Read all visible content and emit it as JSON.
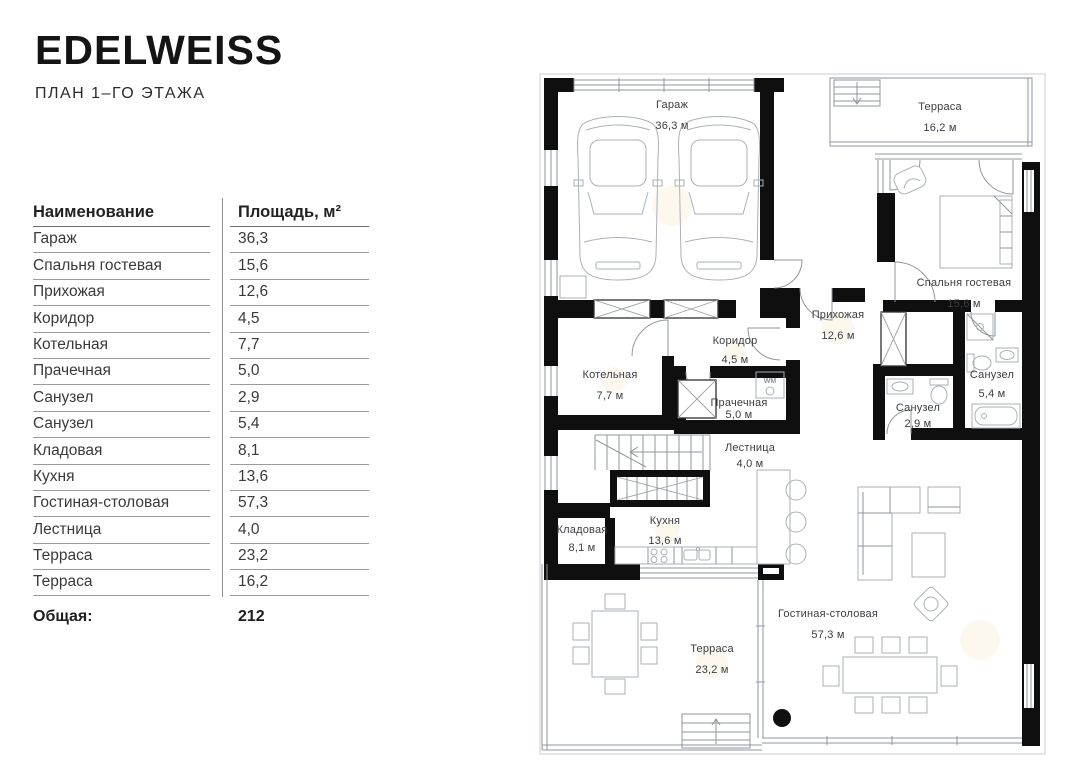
{
  "brand": {
    "logo": "EDELWEISS",
    "subtitle": "ПЛАН 1–ГО ЭТАЖА"
  },
  "table": {
    "header": {
      "name": "Наименование",
      "area": "Площадь, м²"
    },
    "rows": [
      {
        "name": "Гараж",
        "area": "36,3"
      },
      {
        "name": "Спальня гостевая",
        "area": "15,6"
      },
      {
        "name": "Прихожая",
        "area": "12,6"
      },
      {
        "name": "Коридор",
        "area": "4,5"
      },
      {
        "name": "Котельная",
        "area": "7,7"
      },
      {
        "name": "Прачечная",
        "area": "5,0"
      },
      {
        "name": "Санузел",
        "area": "2,9"
      },
      {
        "name": "Санузел",
        "area": "5,4"
      },
      {
        "name": "Кладовая",
        "area": "8,1"
      },
      {
        "name": "Кухня",
        "area": "13,6"
      },
      {
        "name": "Гостиная-столовая",
        "area": "57,3"
      },
      {
        "name": "Лестница",
        "area": "4,0"
      },
      {
        "name": "Терраса",
        "area": "23,2"
      },
      {
        "name": "Терраса",
        "area": "16,2"
      }
    ],
    "total_label": "Общая:",
    "total_value": "212"
  },
  "plan": {
    "wm_label": "WM",
    "rooms": [
      {
        "name": "Гараж",
        "area": "36,3 м"
      },
      {
        "name": "Терраса",
        "area": "16,2 м"
      },
      {
        "name": "Спальня гостевая",
        "area": "15,6 м"
      },
      {
        "name": "Прихожая",
        "area": "12,6 м"
      },
      {
        "name": "Коридор",
        "area": "4,5 м"
      },
      {
        "name": "Котельная",
        "area": "7,7 м"
      },
      {
        "name": "Прачечная",
        "area": "5,0 м"
      },
      {
        "name": "Санузел",
        "area": "5,4 м"
      },
      {
        "name": "Санузел",
        "area": "2,9 м"
      },
      {
        "name": "Лестница",
        "area": "4,0 м"
      },
      {
        "name": "Кладовая",
        "area": "8,1 м"
      },
      {
        "name": "Кухня",
        "area": "13,6 м"
      },
      {
        "name": "Гостиная-столовая",
        "area": "57,3 м"
      },
      {
        "name": "Терраса",
        "area": "23,2 м"
      }
    ]
  }
}
